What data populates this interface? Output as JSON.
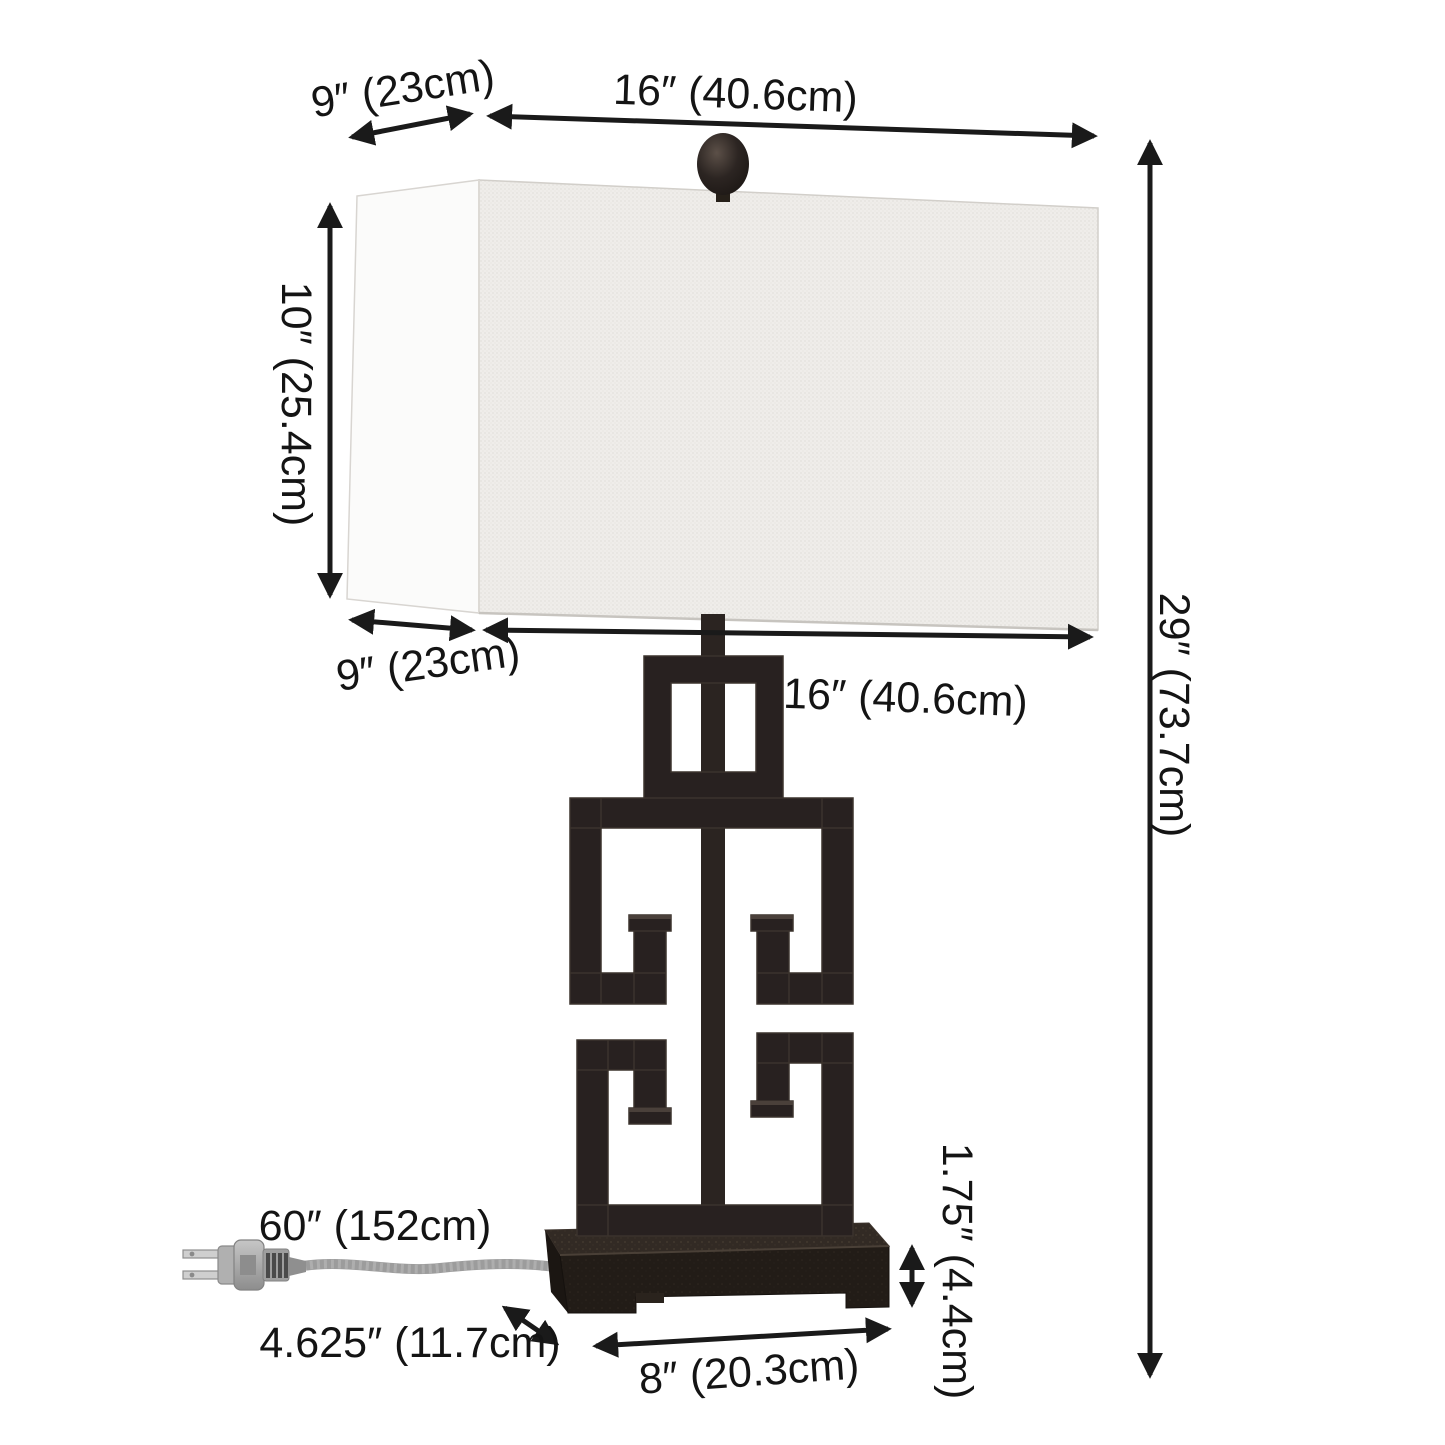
{
  "diagram": {
    "type": "product-dimension-diagram",
    "subject": "Greek-key table lamp with rectangular linen shade, two-prong plug and cord",
    "background_color": "#ffffff",
    "arrow_color": "#1a1a1a",
    "labels": {
      "shade_top_depth": "9″ (23cm)",
      "shade_top_width": "16″ (40.6cm)",
      "shade_height": "10″ (25.4cm)",
      "shade_bottom_depth": "9″ (23cm)",
      "shade_bottom_width": "16″ (40.6cm)",
      "overall_height": "29″ (73.7cm)",
      "cord_length": "60″ (152cm)",
      "base_height": "1.75″ (4.4cm)",
      "base_depth": "4.625″ (11.7cm)",
      "base_width": "8″ (20.3cm)"
    },
    "lamp": {
      "shade_front_color": "#edebe8",
      "shade_side_color": "#fbfbfa",
      "metal_color": "#282120",
      "plinth_top_color": "#322a24",
      "plinth_front_color": "#221c17",
      "cord_color": "#9c9c9c",
      "plug_color": "#b7b7b7"
    }
  }
}
